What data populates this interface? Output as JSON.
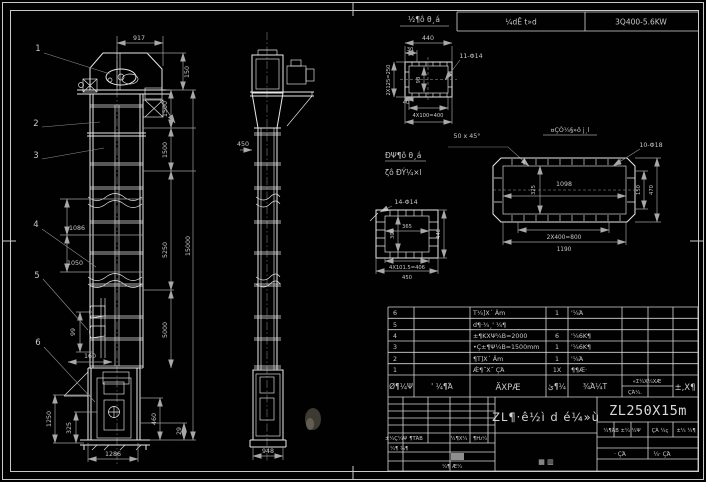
{
  "frame": {
    "note": "¼dÊ t»d",
    "spec": "3Q400-5.6KW"
  },
  "front_view": {
    "balloons": [
      "1",
      "2",
      "3",
      "4",
      "5",
      "6"
    ],
    "dims": {
      "w917": "917",
      "h150": "150",
      "h1500a": "1500",
      "h1500b": "1500",
      "h5250": "5250",
      "h5000": "5000",
      "h15000": "15000",
      "p1086": "1086",
      "p1050": "1050",
      "b99": "99",
      "b160": "160",
      "b1250": "1250",
      "b325": "325",
      "w1286": "1286",
      "h460": "460",
      "h29": "29"
    }
  },
  "side_view": {
    "dims": {
      "o450": "450",
      "w948": "948"
    }
  },
  "detail_outlet": {
    "title": "½¶ô θ¸á",
    "holes": "11-Φ14",
    "dims": {
      "w440": "440",
      "e30": "30",
      "rows": "2X125=250",
      "i98": "98",
      "e40": "40",
      "pitch": "4X100=400"
    }
  },
  "notes": {
    "chamfer": "50 x 45°",
    "label1": "ÐΨ¶ô θ¸á",
    "label2": "ζô ÐÝ¼×l"
  },
  "detail_casing": {
    "title": "¤ÇÒ¼§»ô j¸l",
    "holes": "10-Φ18",
    "dims": {
      "i1098": "1098",
      "i325": "325",
      "h150": "150",
      "h470": "470",
      "pitch": "2X400=800",
      "w1190": "1190"
    }
  },
  "detail_flange": {
    "holes": "14-Φ14",
    "dims": {
      "i365": "365",
      "i300": "300",
      "h440": "440",
      "pitch": "4X101.5=406",
      "w450": "450"
    }
  },
  "parts_table": {
    "headers": {
      "no": "Ø¶¼Ψ",
      "code": "' ¼¶Ά",
      "name": "ÄΧΡÆ",
      "qty": "ئ¶¼",
      "material": "¾Ά¼Τ",
      "weight": "«Σ¼Χ¼ΧÆ",
      "weight_sub": "ÇΆ¼.",
      "remark": "±,Χ¶"
    },
    "rows": [
      {
        "no": "6",
        "code": "",
        "name": "Τ¼]Χ´ Äm",
        "qty": "1",
        "material": "'¼Ά",
        "remark": ""
      },
      {
        "no": "5",
        "code": "",
        "name": "d¶·¾¸' ¼¶",
        "qty": "",
        "material": "",
        "remark": ""
      },
      {
        "no": "4",
        "code": "",
        "name": "±¶ΚΧΨ¼Β=2000",
        "qty": "6",
        "material": "'¼6Κ¶",
        "remark": ""
      },
      {
        "no": "3",
        "code": "",
        "name": "•Ç±¶Ψ¼Β=1500mm",
        "qty": "1",
        "material": "'¼6Κ¶",
        "remark": ""
      },
      {
        "no": "2",
        "code": "",
        "name": "¶Τ]Χ´ Äm",
        "qty": "1",
        "material": "'¼Ά",
        "remark": ""
      },
      {
        "no": "1",
        "code": "",
        "name": "Ǽ¶˝Χ˝ ÇΆ",
        "qty": "1X",
        "material": "¶¶Æ·",
        "remark": ""
      }
    ]
  },
  "title_block": {
    "product": "ZL¶·ê½ì d é¼»ù",
    "drawing_no": "ZL250X15m",
    "stamp": "▦ ▥",
    "rev_cols": [
      "±¼Ç¼Ψ",
      "¶ΤΆΒ",
      "¼¶Χ¼",
      "¶Ƕ¼"
    ],
    "sign1": "¼¶ ¾¶",
    "sign2": "¼¶ Æ¼",
    "stage": "¼¶ΆΒ ±¼ ¼Ψ",
    "mass": "ÇΆ ¼ç",
    "scale": "±¼ ¼¶",
    "sheet_total": "· ÇΆ",
    "sheet_no": "¼· ÇΆ"
  }
}
